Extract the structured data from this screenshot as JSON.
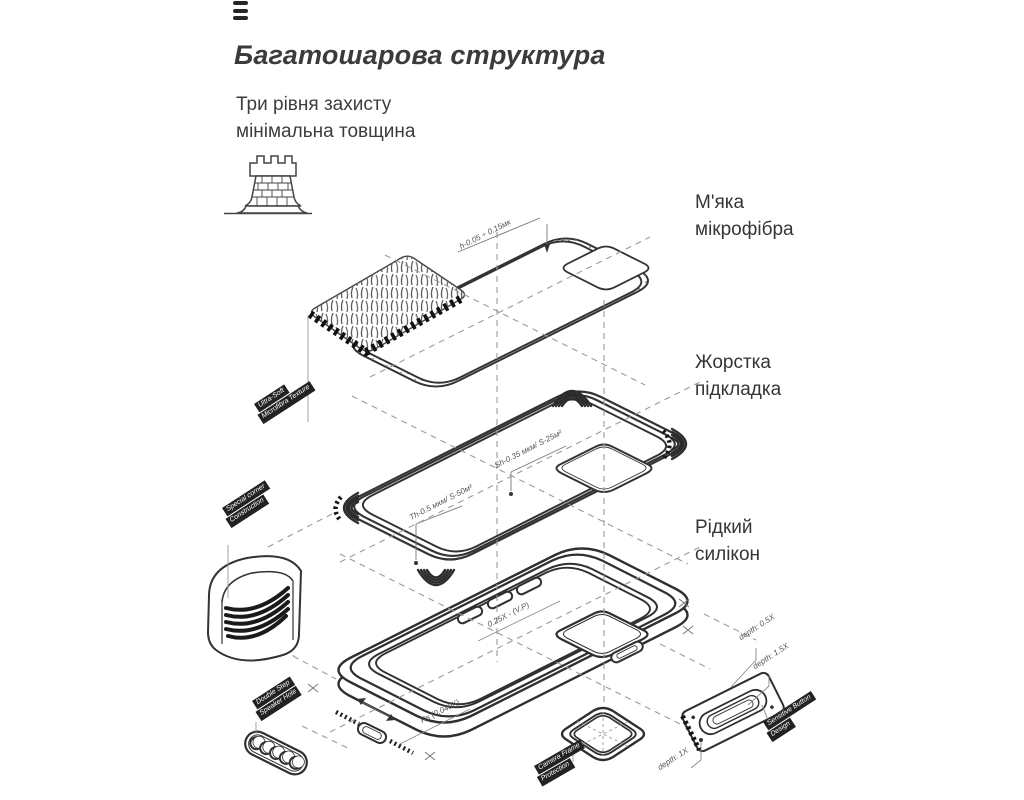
{
  "header": {
    "title": "Багатошарова структура",
    "subtitle1": "Три рівня захисту",
    "subtitle2": "мінімальна товщина"
  },
  "labels": {
    "microfiber": {
      "line1": "М'яка",
      "line2": "мікрофібра"
    },
    "lining": {
      "line1": "Жорстка",
      "line2": "підкладка"
    },
    "silicone": {
      "line1": "Рідкий",
      "line2": "силікон"
    }
  },
  "tags": {
    "texture": {
      "line1": "Ultra-Soft",
      "line2": "Microfibra Texture"
    },
    "corner": {
      "line1": "Special corner",
      "line2": "Construction"
    },
    "speaker": {
      "line1": "Double Step",
      "line2": "Speaker Hole"
    },
    "camera": {
      "line1": "Camera Frame",
      "line2": "Protection"
    },
    "button": {
      "line1": "Sensitive Button",
      "line2": "Design"
    }
  },
  "annotations": {
    "sheet_thickness": "h-0.05 ÷ 0.15мк",
    "lining_top": "Sh-0.35 мкм/ S-25м²",
    "lining_bottom": "Th-0.5 мкм/ S-50м²",
    "case_top": "0.25X - (V.P)",
    "case_bottom": "Rs (0.040X)",
    "depth_half": "depth: 0.5X",
    "depth_one_half": "depth: 1.5X",
    "depth_one": "depth: 1X"
  },
  "icons": {
    "menu": "triple-bar-menu-icon",
    "tower": "castle-tower-icon"
  },
  "colors": {
    "ink": "#3b3b3b",
    "line": "#333333",
    "guide": "#9a9a9a",
    "tag_bg": "#222222",
    "tag_text": "#ffffff"
  }
}
